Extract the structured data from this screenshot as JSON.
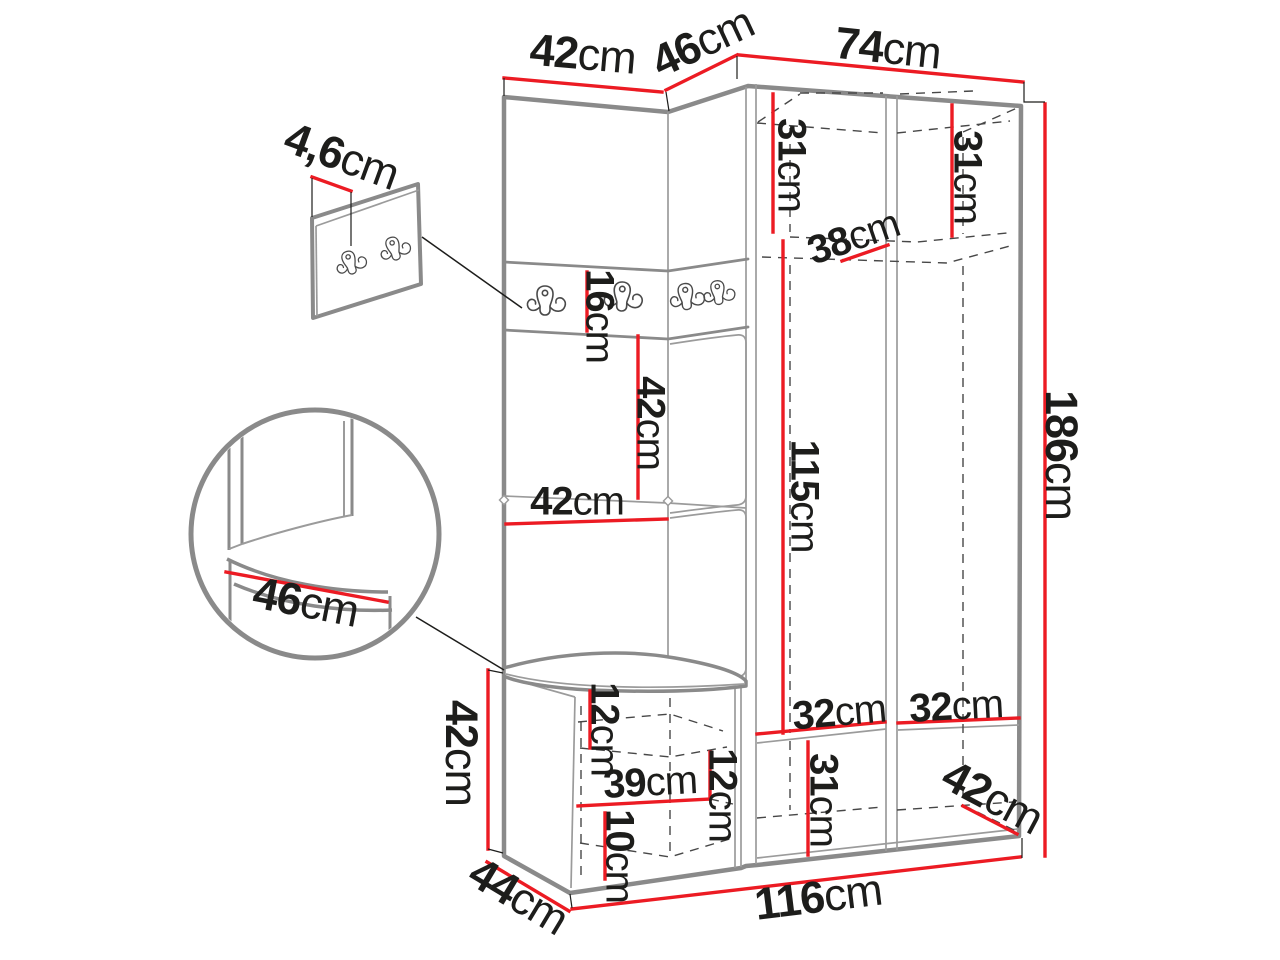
{
  "colors": {
    "accent": "#ec1b23",
    "outline": "#8a8a8a",
    "outline-thin": "#9b9b9b",
    "hidden": "#474747",
    "ink": "#1d1d1b",
    "background": "#ffffff"
  },
  "icons": {
    "hook": "coat-hook",
    "detail_circle": "zoom-detail-circle",
    "hook_panel": "wall-hook-panel-detail"
  },
  "labels": {
    "top_left_width": {
      "value": "42",
      "unit": "cm"
    },
    "top_corner_width": {
      "value": "46",
      "unit": "cm"
    },
    "top_right_width": {
      "value": "74",
      "unit": "cm"
    },
    "panel_thickness": {
      "value": "4,6",
      "unit": "cm"
    },
    "upper_left_height": {
      "value": "31",
      "unit": "cm"
    },
    "upper_right_height": {
      "value": "31",
      "unit": "cm"
    },
    "shelf_depth": {
      "value": "38",
      "unit": "cm"
    },
    "hook_strip_height": {
      "value": "16",
      "unit": "cm"
    },
    "niche_height": {
      "value": "42",
      "unit": "cm"
    },
    "shelf_width": {
      "value": "42",
      "unit": "cm"
    },
    "hanging_height": {
      "value": "115",
      "unit": "cm"
    },
    "total_height": {
      "value": "186",
      "unit": "cm"
    },
    "seat_depth": {
      "value": "46",
      "unit": "cm"
    },
    "bench_height": {
      "value": "42",
      "unit": "cm"
    },
    "bench_depth": {
      "value": "44",
      "unit": "cm"
    },
    "bench_top_inset": {
      "value": "12",
      "unit": "cm"
    },
    "bench_shelf_width": {
      "value": "39",
      "unit": "cm"
    },
    "bench_lower_height": {
      "value": "10",
      "unit": "cm"
    },
    "bench_side_inset": {
      "value": "12",
      "unit": "cm"
    },
    "lower_compartment_height": {
      "value": "31",
      "unit": "cm"
    },
    "lower_left_width": {
      "value": "32",
      "unit": "cm"
    },
    "lower_right_width": {
      "value": "32",
      "unit": "cm"
    },
    "lower_corner_depth": {
      "value": "42",
      "unit": "cm"
    },
    "total_width": {
      "value": "116",
      "unit": "cm"
    }
  }
}
